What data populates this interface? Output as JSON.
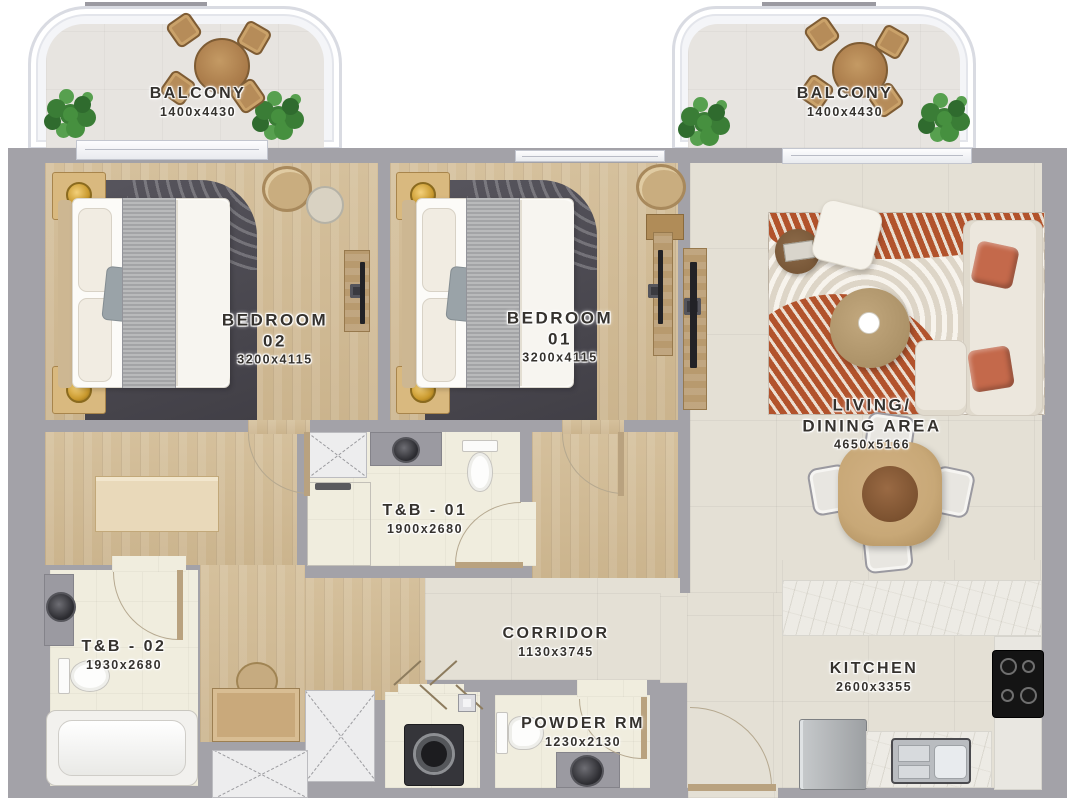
{
  "rooms": {
    "balcony_left": {
      "name": "BALCONY",
      "dims": "1400x4430"
    },
    "balcony_right": {
      "name": "BALCONY",
      "dims": "1400x4430"
    },
    "bedroom_02": {
      "name": "BEDROOM",
      "number": "02",
      "dims": "3200x4115"
    },
    "bedroom_01": {
      "name": "BEDROOM",
      "number": "01",
      "dims": "3200x4115"
    },
    "living": {
      "name_line1": "LIVING/",
      "name_line2": "DINING AREA",
      "dims": "4650x5166"
    },
    "tb_01": {
      "name": "T&B - 01",
      "dims": "1900x2680"
    },
    "tb_02": {
      "name": "T&B - 02",
      "dims": "1930x2680"
    },
    "corridor": {
      "name": "CORRIDOR",
      "dims": "1130x3745"
    },
    "kitchen": {
      "name": "KITCHEN",
      "dims": "2600x3355"
    },
    "powder": {
      "name": "POWDER RM",
      "dims": "1230x2130"
    }
  },
  "colors": {
    "wall": "#a3a2a8",
    "wood": "#d5c09c",
    "tile": "#e4e0d5",
    "bath": "#f0edde",
    "marble": "#edebe5",
    "closet": "#ededee",
    "rug": "#b2532c",
    "sofa": "#ece7dd",
    "pillow": "#c4694b",
    "plant": "#3e8039",
    "furn": "#c8a877",
    "ink": "#35322e"
  }
}
